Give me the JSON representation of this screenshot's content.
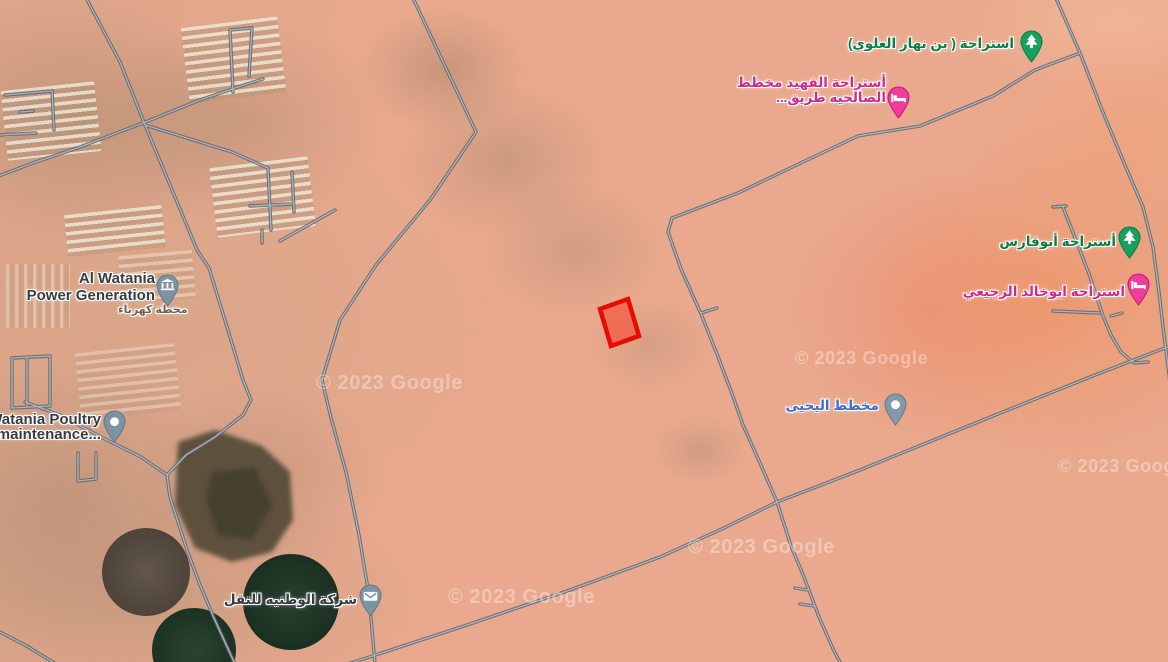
{
  "map": {
    "kind": "satellite-map-view",
    "selection": {
      "shape": "parcel-polygon"
    }
  },
  "colors": {
    "terrain_base": "#ecaa8e",
    "road_casing": "#5f666e",
    "road_fill": "#b3b8be",
    "parcel_stroke": "#e80b00",
    "parcel_fill": "rgba(255,32,14,0.42)",
    "green_label": "#0a7d42",
    "pink_label": "#cf2b8a",
    "blue_label": "#3d6ed0",
    "dark_label": "#383d42",
    "green_pin": "#16a15e",
    "pink_pin": "#ef3d99",
    "slate_pin": "#7e93a2"
  },
  "labels": {
    "bin_nahar": {
      "text": "استراحة ( بن نهار العلوي)",
      "icon": "tree-pin"
    },
    "fahid": {
      "line1": "أستراحة الفهيد مخطط",
      "line2": "الصالحيه طريق...",
      "icon": "bed-pin"
    },
    "abufaris": {
      "text": "أستراحة أبوفارس",
      "icon": "tree-pin"
    },
    "abukhalid": {
      "text": "استراحة ابوخالد الرجيعي",
      "icon": "bed-pin"
    },
    "yahya": {
      "text": "مخطط اليحيى",
      "icon": "place-dot-pin"
    },
    "watania_power": {
      "line1": "Al Watania",
      "line2": "Power Generation",
      "sub": "محطة كهرباء",
      "icon": "bank-pin"
    },
    "watania_poultry": {
      "line1": "Watania Poultry",
      "line2": "al maintenance...",
      "icon": "place-dot-pin"
    },
    "watania_transport": {
      "text": "شركة الوطنيه للنقل",
      "icon": "mail-pin"
    }
  },
  "watermark": {
    "text": "© 2023 Google"
  }
}
